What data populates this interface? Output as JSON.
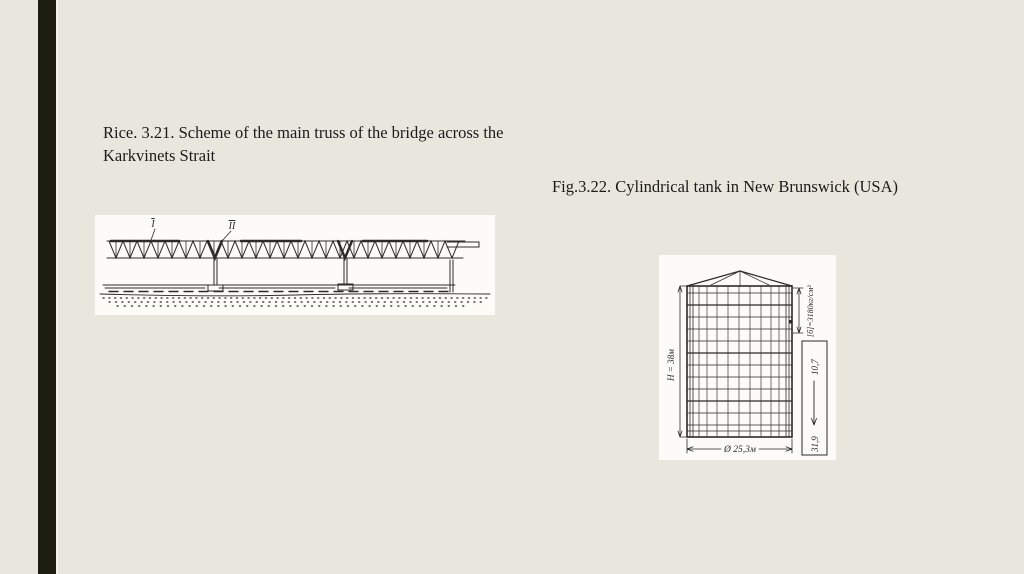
{
  "colors": {
    "background": "#e9e6dd",
    "accent_bar": "#1c1d11",
    "ink": "#1b1b1b",
    "figure_paper": "#fcfbf7"
  },
  "captions": {
    "bridge_line1": "Rice. 3.21. Scheme of the main truss of the bridge across the",
    "bridge_line2": "Karkvinets Strait",
    "tank": "Fig.3.22. Cylindrical tank in New Brunswick (USA)"
  },
  "figures": {
    "bridge": {
      "truss_label_1": "I",
      "truss_label_2": "II"
    },
    "tank": {
      "height_dimension": "H = 38м",
      "diameter_dimension": "Ø 25,3м",
      "stress_annotation": "[б]=3180кг/см²",
      "upper_value": "10,7",
      "lower_value": "31,9"
    }
  }
}
